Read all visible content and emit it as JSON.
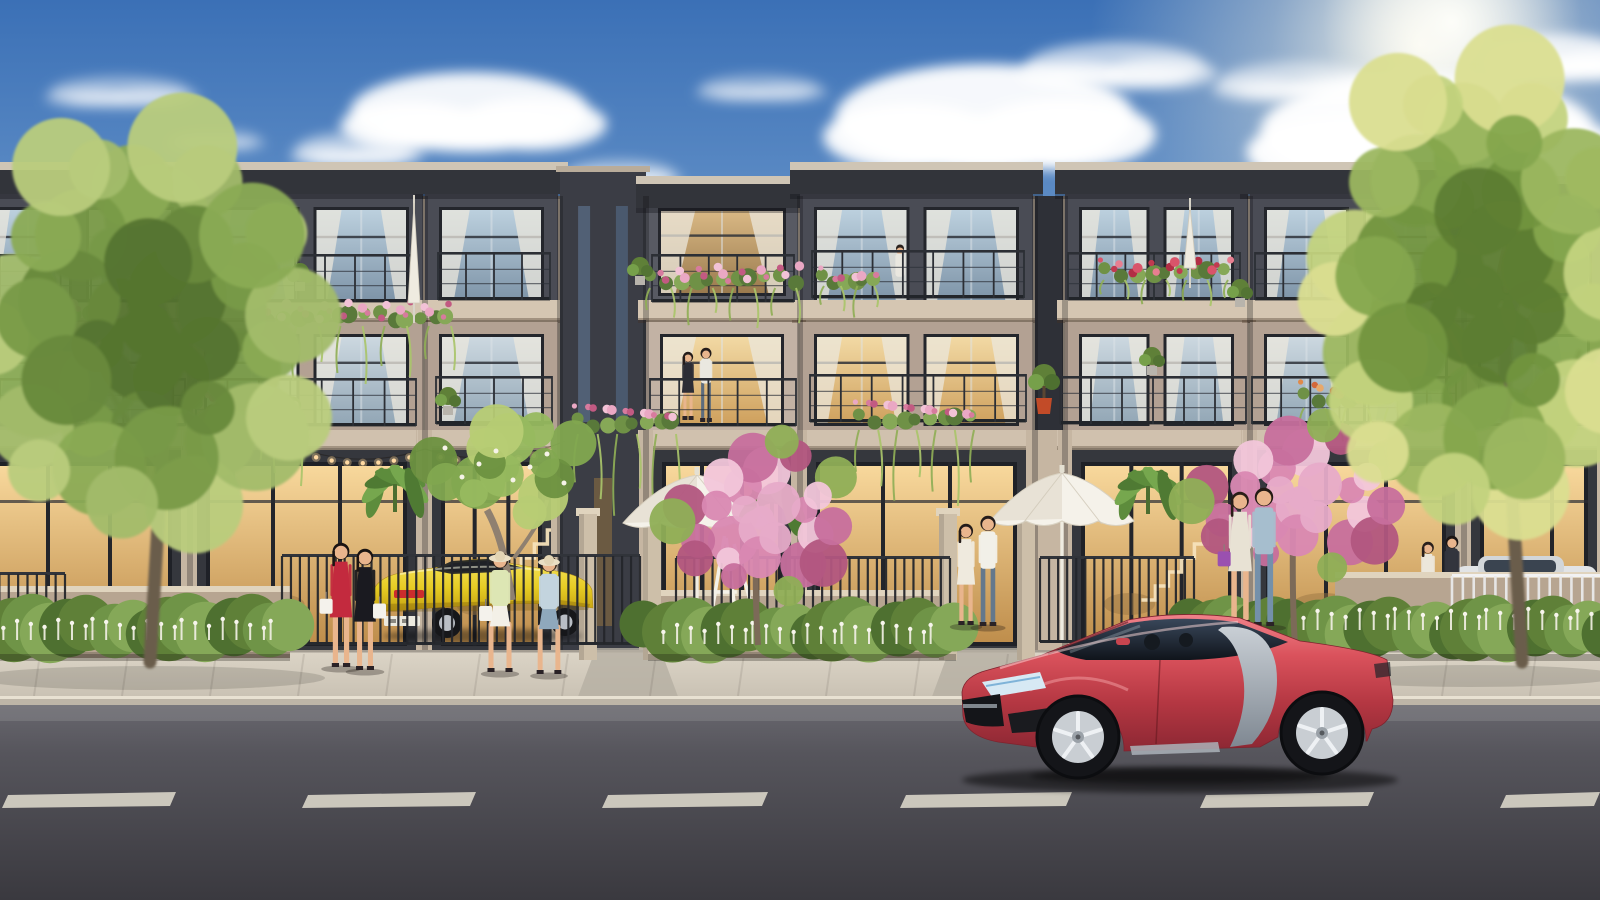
{
  "image_type": "photorealistic architectural rendering, no visible text",
  "palette": {
    "sky_top": "#3b70b6",
    "sky_mid": "#6f9bcd",
    "sky_horizon": "#d4e4ef",
    "sun_glow": "#fffdf4",
    "cloud": "#ffffff",
    "roof_dark": "#32343a",
    "roof_light": "#cfc5b5",
    "facade_dark": "#4a4c55",
    "facade_dark_recessed": "#585a63",
    "tower_dark": "#3b3d45",
    "facade_beige": "#b3a193",
    "facade_beige_light": "#c2b2a4",
    "slab": "#d5c6b2",
    "slab2": "#d0c1ae",
    "pillar": "#c6b6a2",
    "frame_dark": "#24262c",
    "wall_ground": "#35373d",
    "glass_cool_top": "#bcd0de",
    "glass_cool_bot": "#7e94a8",
    "glass_warm_top": "#f2d9a4",
    "glass_warm_bot": "#cfa15e",
    "ground_glow_top": "#f8d89c",
    "ground_glow_bot": "#bf8e4c",
    "railing": "#2c2f35",
    "flower_pink": "#e2a0c2",
    "flower_red": "#d4556a",
    "flower_orange": "#df8a4e",
    "leaf": "#6f9146",
    "vine": "#8fae56",
    "hedge": "#5f8038",
    "white_flower": "#f1efe4",
    "tree_green": "#789a47",
    "tree_sunlit": "#dade90",
    "pink_tree": "#d988b2",
    "trunk": "#6a5d4b",
    "planter_wall": "#b7a591",
    "wall_ledge": "#e0d4be",
    "sidewalk": "#dcd5c7",
    "curb": "#e8e1d2",
    "road_top": "#68676e",
    "road_bottom": "#3a393f",
    "lane_dash": "#ddd8cb",
    "car_red_main": "#da525c",
    "car_red_dark": "#8c2733",
    "car_blade_silver": "#a8b0b8",
    "car_rim": "#c9ced3",
    "car_tire": "#141519",
    "car_yellow": "#e6cc24",
    "car_white": "#e2e4e6",
    "skin": "#e9b58d",
    "umbrella_white": "#f5f2ea",
    "string_light_bulb": "#ffd9a2"
  },
  "scene": {
    "clouds": [
      {
        "cx": 470,
        "cy": 112,
        "rx": 120,
        "ry": 40,
        "o": 0.92
      },
      {
        "cx": 355,
        "cy": 150,
        "rx": 60,
        "ry": 18,
        "o": 0.5
      },
      {
        "cx": 620,
        "cy": 175,
        "rx": 55,
        "ry": 15,
        "o": 0.45
      },
      {
        "cx": 985,
        "cy": 118,
        "rx": 150,
        "ry": 54,
        "o": 0.95
      },
      {
        "cx": 878,
        "cy": 185,
        "rx": 70,
        "ry": 20,
        "o": 0.55
      },
      {
        "cx": 1115,
        "cy": 66,
        "rx": 90,
        "ry": 24,
        "o": 0.6
      },
      {
        "cx": 1428,
        "cy": 132,
        "rx": 168,
        "ry": 58,
        "o": 0.97
      },
      {
        "cx": 1298,
        "cy": 82,
        "rx": 80,
        "ry": 20,
        "o": 0.5
      },
      {
        "cx": 120,
        "cy": 92,
        "rx": 70,
        "ry": 16,
        "o": 0.4
      },
      {
        "cx": 215,
        "cy": 140,
        "rx": 45,
        "ry": 11,
        "o": 0.3
      },
      {
        "cx": 1560,
        "cy": 58,
        "rx": 70,
        "ry": 24,
        "o": 0.8
      },
      {
        "cx": 760,
        "cy": 88,
        "rx": 60,
        "ry": 14,
        "o": 0.35
      }
    ],
    "buildings": {
      "units": [
        {
          "x": -30,
          "w": 218,
          "t": "A",
          "f2": "cool"
        },
        {
          "x": 190,
          "w": 233,
          "t": "A",
          "f2": "cool"
        },
        {
          "x": 425,
          "w": 133,
          "t": "A",
          "f2": "cool",
          "stair": true
        },
        {
          "x": 560,
          "w": 86,
          "t": "T"
        },
        {
          "x": 646,
          "w": 152,
          "t": "B",
          "f2": "warm"
        },
        {
          "x": 800,
          "w": 233,
          "t": "A",
          "f2": "warm"
        },
        {
          "x": 1035,
          "w": 28,
          "t": "T2"
        },
        {
          "x": 1065,
          "w": 183,
          "t": "A",
          "f2": "cool",
          "stair": true
        },
        {
          "x": 1250,
          "w": 212,
          "t": "A",
          "f2": "cool"
        },
        {
          "x": 1464,
          "w": 140,
          "t": "B",
          "f2": "cool"
        }
      ],
      "seams": [
        190,
        425,
        560,
        646,
        800,
        1035,
        1065,
        1250,
        1464
      ],
      "railings_f3": [
        [
          0,
          254,
          182
        ],
        [
          205,
          254,
          210
        ],
        [
          438,
          252,
          112
        ],
        [
          652,
          254,
          142
        ],
        [
          812,
          250,
          212
        ],
        [
          1068,
          252,
          172
        ],
        [
          1255,
          252,
          198
        ]
      ],
      "railings_f2": [
        [
          0,
          378,
          185
        ],
        [
          196,
          378,
          220
        ],
        [
          436,
          376,
          116
        ],
        [
          650,
          378,
          146
        ],
        [
          810,
          374,
          216
        ],
        [
          1060,
          376,
          186
        ],
        [
          1252,
          376,
          204
        ]
      ],
      "flowerboxes": [
        {
          "x": 0,
          "y": 300,
          "w": 95,
          "h": 26,
          "hang": 50,
          "c": "pink"
        },
        {
          "x": 248,
          "y": 302,
          "w": 207,
          "h": 26,
          "hang": 58,
          "c": "pink"
        },
        {
          "x": 193,
          "y": 392,
          "w": 109,
          "h": 28,
          "hang": 68,
          "c": "pink"
        },
        {
          "x": 574,
          "y": 406,
          "w": 106,
          "h": 30,
          "hang": 88,
          "c": "pink"
        },
        {
          "x": 646,
          "y": 266,
          "w": 154,
          "h": 24,
          "hang": 40,
          "c": "pink"
        },
        {
          "x": 820,
          "y": 268,
          "w": 58,
          "h": 20,
          "hang": 34,
          "c": "pink"
        },
        {
          "x": 855,
          "y": 402,
          "w": 123,
          "h": 30,
          "hang": 76,
          "c": "pink"
        },
        {
          "x": 1100,
          "y": 260,
          "w": 132,
          "h": 22,
          "hang": 26,
          "c": "red"
        },
        {
          "x": 1300,
          "y": 382,
          "w": 92,
          "h": 28,
          "hang": 36,
          "c": "orange"
        }
      ],
      "balcony_plants": [
        [
          300,
          272
        ],
        [
          640,
          266
        ],
        [
          1240,
          288
        ],
        [
          448,
          396
        ],
        [
          1152,
          356
        ],
        [
          78,
          258
        ]
      ],
      "pot_plant": {
        "x": 1044,
        "y": 390
      },
      "gate_pillars": [
        588,
        652,
        948,
        1026
      ],
      "planter_walls": [
        {
          "x": -10,
          "y": 592,
          "w": 300,
          "h": 66
        },
        {
          "x": 660,
          "y": 596,
          "w": 295,
          "h": 62
        },
        {
          "x": 1335,
          "y": 578,
          "w": 270,
          "h": 56
        }
      ],
      "aprons": [
        [
          596,
          660
        ],
        [
          950,
          1030
        ],
        [
          1235,
          1320
        ]
      ]
    },
    "props": {
      "fences_dark": [
        {
          "x": 282,
          "w": 358,
          "y": 554,
          "h": 92
        },
        {
          "x": 676,
          "w": 274,
          "y": 556,
          "h": 90
        },
        {
          "x": 1040,
          "w": 154,
          "y": 556,
          "h": 88
        },
        {
          "x": -10,
          "w": 75,
          "y": 572,
          "h": 82
        }
      ],
      "fence_white": {
        "x": 1452,
        "w": 152,
        "y": 574,
        "h": 72
      },
      "umbrellas_open": [
        {
          "cx": 697,
          "cy": 523,
          "rx": 74
        },
        {
          "cx": 1062,
          "cy": 521,
          "rx": 72
        }
      ],
      "umbrellas_closed": [
        {
          "x": 414,
          "y": 203,
          "h": 100
        },
        {
          "x": 1190,
          "y": 206,
          "h": 62
        }
      ],
      "string_lights": [
        {
          "x1": 285,
          "y1": 443,
          "x2": 425,
          "y2": 449,
          "sag": 26,
          "bulbs": 9
        },
        {
          "x1": 425,
          "y1": 449,
          "x2": 565,
          "y2": 441,
          "sag": 26,
          "bulbs": 9
        }
      ],
      "ladder_stand": {
        "x": 706,
        "y": 536,
        "w": 56,
        "h": 112
      }
    },
    "greenery": {
      "hedges": [
        {
          "x": -10,
          "w": 300,
          "y": 598,
          "h": 60
        },
        {
          "x": 648,
          "w": 308,
          "y": 602,
          "h": 56
        },
        {
          "x": 1195,
          "w": 132,
          "y": 600,
          "h": 55
        },
        {
          "x": 1295,
          "w": 315,
          "y": 600,
          "h": 58
        }
      ],
      "white_flower_rows": [
        {
          "x": 0,
          "w": 280,
          "y": 640
        },
        {
          "x": 660,
          "w": 280,
          "y": 644
        },
        {
          "x": 1300,
          "w": 300,
          "y": 630
        }
      ],
      "banana": [
        [
          395,
          498
        ],
        [
          772,
          516
        ],
        [
          1148,
          500
        ]
      ],
      "frangipani": {
        "x": 512,
        "y": 600,
        "cx": 505,
        "cy": 468
      },
      "pink_trees": [
        {
          "cx": 762,
          "cy": 518,
          "rx": 95,
          "ry": 82,
          "trunk": 758
        },
        {
          "cx": 1300,
          "cy": 498,
          "rx": 115,
          "ry": 78,
          "trunk": 1295
        }
      ],
      "big_trees": [
        {
          "cx": 148,
          "cy": 330,
          "rx": 165,
          "ry": 196,
          "n": 44,
          "trunkX": 150,
          "sun": false,
          "clampMax": 322,
          "lean": 1
        },
        {
          "cx": 1478,
          "cy": 290,
          "rx": 152,
          "ry": 226,
          "n": 46,
          "trunkX": 1522,
          "sun": true,
          "clampMin": 1332,
          "lean": -1
        }
      ]
    },
    "people": [
      {
        "layer": "balcony",
        "x": 688,
        "y": 352,
        "h": 68,
        "hair": "#241c1a",
        "top": "#2c2d35",
        "kind": "dress"
      },
      {
        "layer": "balcony",
        "x": 706,
        "y": 348,
        "h": 74,
        "hair": "#241c1a",
        "top": "#eae8e0",
        "pants": "#5c6c7e",
        "kind": "stand"
      },
      {
        "layer": "balcony",
        "x": 900,
        "y": 246,
        "h": 42,
        "hair": "#2a221e",
        "top": "#e9e7df",
        "kind": "mini"
      },
      {
        "layer": "street",
        "x": 341,
        "y": 543,
        "h": 124,
        "hair": "#1b1412",
        "top": "#c32a3e",
        "kind": "dress",
        "bag": "#f4f2ec",
        "bagSide": -1
      },
      {
        "layer": "street",
        "x": 365,
        "y": 549,
        "h": 121,
        "hair": "#1b1412",
        "top": "#1a1a20",
        "kind": "dress",
        "bag": "#f4f2ec",
        "bagSide": 1
      },
      {
        "layer": "street",
        "x": 500,
        "y": 552,
        "h": 120,
        "hair": "#2c2019",
        "top": "#dde6b4",
        "skirt": "#f3f0e7",
        "kind": "walk",
        "hat": true,
        "bag": "#f4f2ec",
        "bagSide": -1
      },
      {
        "layer": "street",
        "x": 549,
        "y": 556,
        "h": 118,
        "hair": "#3a2a1c",
        "top": "#c3d4de",
        "skirt": "#8fa8bc",
        "kind": "walk",
        "hat": true
      },
      {
        "layer": "street",
        "x": 966,
        "y": 524,
        "h": 101,
        "hair": "#241c1a",
        "top": "#efeade",
        "kind": "dress"
      },
      {
        "layer": "street",
        "x": 988,
        "y": 516,
        "h": 110,
        "hair": "#241c1a",
        "top": "#f2f0e8",
        "pants": "#64788c",
        "kind": "stand"
      },
      {
        "layer": "terrace",
        "x": 1240,
        "y": 492,
        "h": 132,
        "hair": "#2a1e18",
        "top": "#e8e2d4",
        "skirt": "#f4f1ea",
        "kind": "dress",
        "bag": "#9a50b0",
        "bagSide": -1
      },
      {
        "layer": "terrace",
        "x": 1264,
        "y": 488,
        "h": 138,
        "hair": "#241a14",
        "top": "#a6bece",
        "pants": "#7490aa",
        "kind": "stand"
      },
      {
        "layer": "backwall",
        "x": 1428,
        "y": 542,
        "h": 80,
        "hair": "#2a201c",
        "top": "#ece7db",
        "kind": "dress"
      },
      {
        "layer": "backwall",
        "x": 1452,
        "y": 536,
        "h": 88,
        "hair": "#1c1614",
        "top": "#33353d",
        "pants": "#3c3e46",
        "kind": "stand"
      }
    ],
    "road": {
      "y": 705,
      "dash_y": 795,
      "dashes": [
        [
          8,
          168
        ],
        [
          308,
          168
        ],
        [
          608,
          160
        ],
        [
          906,
          166
        ],
        [
          1206,
          168
        ],
        [
          1506,
          94
        ]
      ]
    }
  }
}
